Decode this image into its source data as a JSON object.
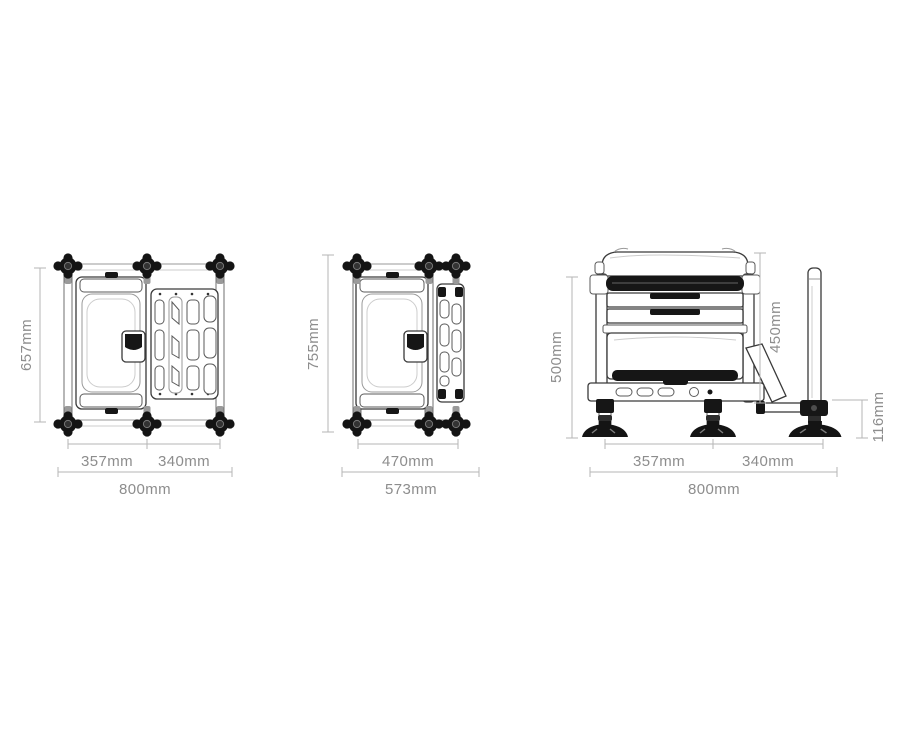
{
  "diagram": {
    "type": "technical-dimension-drawing",
    "subject": "seatbox station with footplate - three orthographic views",
    "units": "mm",
    "colors": {
      "background": "#ffffff",
      "line_art": "#3a3a3a",
      "dark_fill": "#161616",
      "dimension_line": "#b5b5b5",
      "dimension_text": "#8d8d8d"
    },
    "views": [
      {
        "id": "top-view-extended",
        "dims": {
          "height": "657mm",
          "span_left": "357mm",
          "span_right": "340mm",
          "total_width": "800mm"
        }
      },
      {
        "id": "top-view-folded",
        "dims": {
          "height": "755mm",
          "inner_width": "470mm",
          "total_width": "573mm"
        }
      },
      {
        "id": "side-view",
        "dims": {
          "frame_height": "500mm",
          "pole_height": "450mm",
          "rail_height": "116mm",
          "span_left": "357mm",
          "span_right": "340mm",
          "total_width": "800mm"
        }
      }
    ]
  }
}
